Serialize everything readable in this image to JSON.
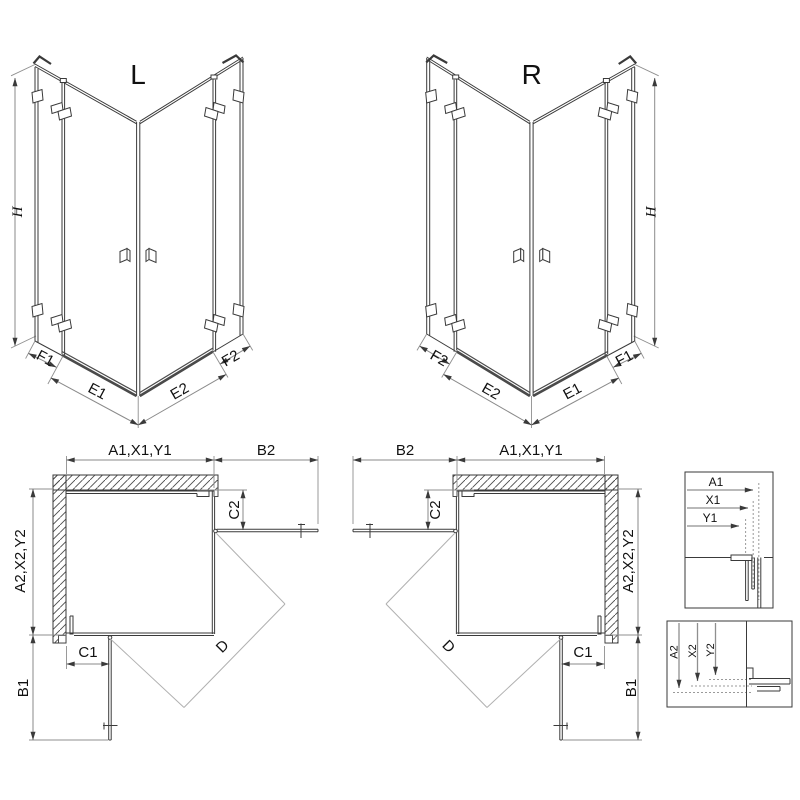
{
  "colors": {
    "line": "#3a3a3a",
    "dimension_line": "#8a8a8a",
    "light_diagonal": "#b0b0b0",
    "background": "#ffffff"
  },
  "iso_views": [
    {
      "variant_label": "L",
      "height_label": "H",
      "bottom_labels": [
        "F1",
        "E1",
        "E2",
        "F2"
      ]
    },
    {
      "variant_label": "R",
      "height_label": "H",
      "bottom_labels": [
        "F2",
        "E2",
        "E1",
        "F1"
      ]
    }
  ],
  "plan_views": [
    {
      "top_width_label": "A1,X1,Y1",
      "door_span_label": "B2",
      "return_panel_label": "C2",
      "side_depth_label": "A2,X2,Y2",
      "side_door_span_label": "B1",
      "side_return_label": "C1",
      "diagonal_label": "D"
    },
    {
      "top_width_label": "A1,X1,Y1",
      "door_span_label": "B2",
      "return_panel_label": "C2",
      "side_depth_label": "A2,X2,Y2",
      "side_door_span_label": "B1",
      "side_return_label": "C1",
      "diagonal_label": "D"
    }
  ],
  "profile_details": [
    {
      "labels": [
        "A1",
        "X1",
        "Y1"
      ]
    },
    {
      "labels": [
        "A2",
        "X2",
        "Y2"
      ]
    }
  ]
}
